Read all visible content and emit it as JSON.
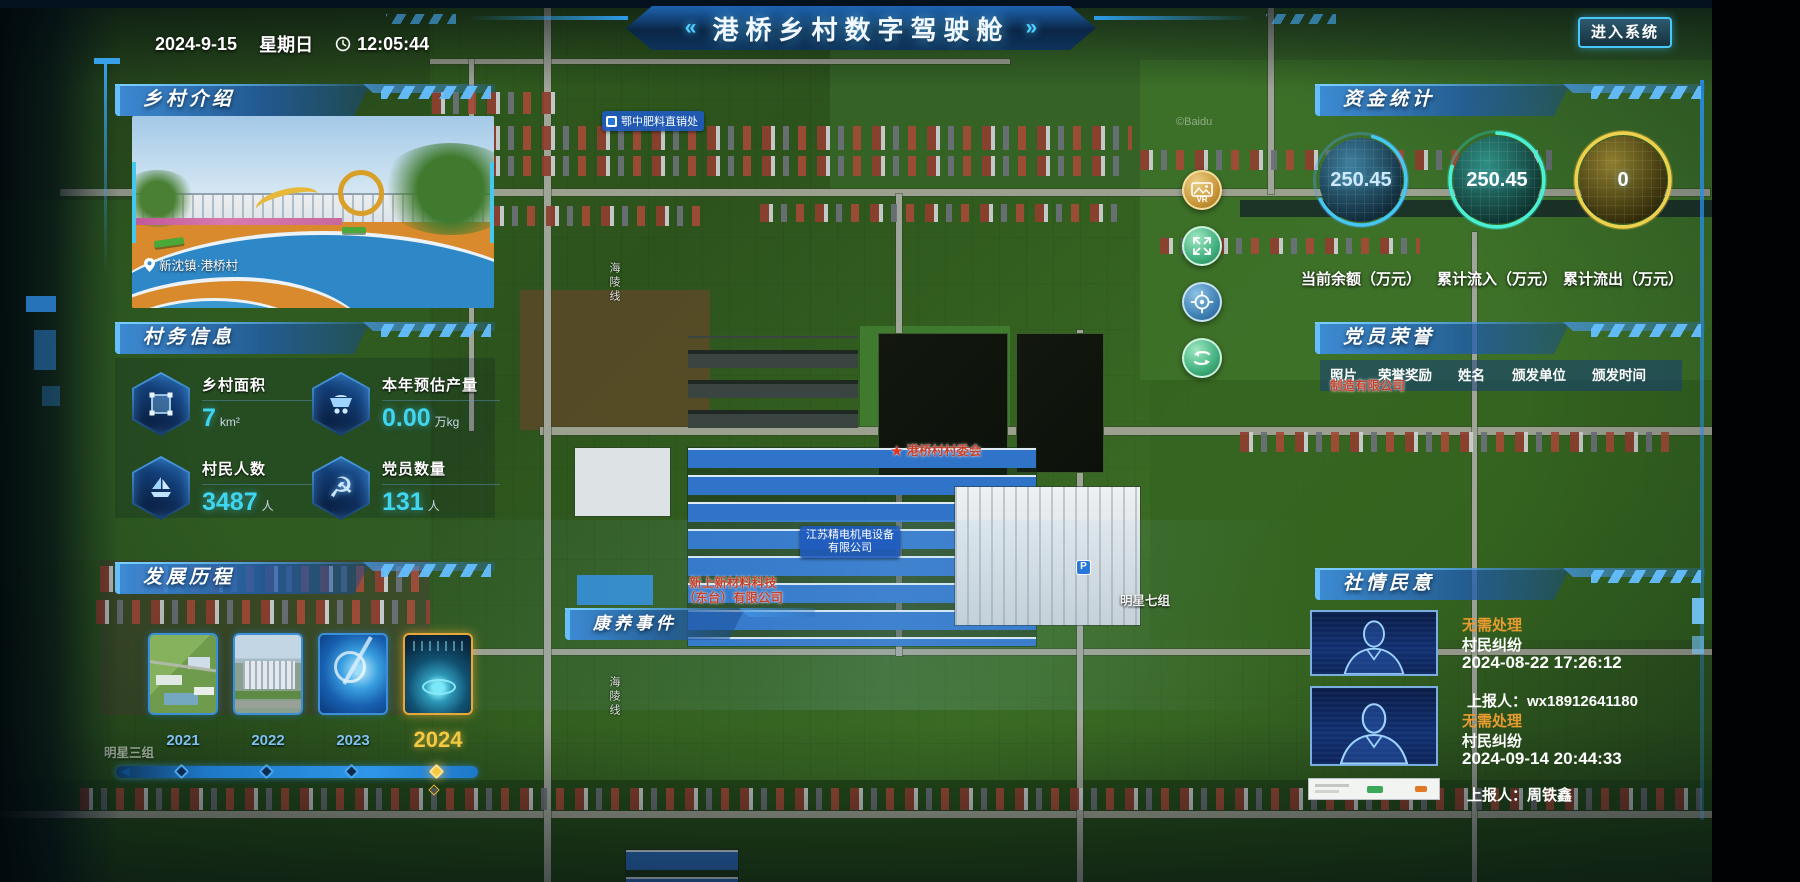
{
  "header": {
    "date": "2024-9-15",
    "weekday": "星期日",
    "time": "12:05:44",
    "deco_left": "«",
    "title": "港桥乡村数字驾驶舱",
    "deco_right": "»",
    "enter_button": "进入系统"
  },
  "left": {
    "intro": {
      "title": "乡村介绍",
      "photo_caption": "新沈镇·港桥村"
    },
    "info": {
      "title": "村务信息",
      "stats": [
        {
          "label": "乡村面积",
          "value": "7",
          "unit": "km²"
        },
        {
          "label": "本年预估产量",
          "value": "0.00",
          "unit": "万kg"
        },
        {
          "label": "村民人数",
          "value": "3487",
          "unit": "人"
        },
        {
          "label": "党员数量",
          "value": "131",
          "unit": "人"
        }
      ]
    },
    "development": {
      "title": "发展历程",
      "years": [
        "2021",
        "2022",
        "2023",
        "2024"
      ],
      "active_year": "2024"
    }
  },
  "right": {
    "funds": {
      "title": "资金统计",
      "gauges": [
        {
          "value": "250.45",
          "label": "当前余额（万元）"
        },
        {
          "value": "250.45",
          "label": "累计流入（万元）"
        },
        {
          "value": "0",
          "label": "累计流出（万元）"
        }
      ]
    },
    "party": {
      "title": "党员荣誉",
      "columns": [
        "照片",
        "荣誉奖励",
        "姓名",
        "颁发单位",
        "颁发时间"
      ]
    },
    "sentiment": {
      "title": "社情民意",
      "items": [
        {
          "status": "无需处理",
          "category": "村民纠纷",
          "datetime": "2024-08-22 17:26:12",
          "reporter": "上报人：wx18912641180"
        },
        {
          "status": "无需处理",
          "category": "村民纠纷",
          "datetime": "2024-09-14 20:44:33",
          "reporter": "上报人：周铁鑫"
        }
      ]
    }
  },
  "center": {
    "health_panel_title": "康养事件"
  },
  "map_labels": {
    "fertilizer_poi": "鄂中肥料直销处",
    "village_committee": "港桥村村委会",
    "company_blue_1": "江苏精电机电设备",
    "company_blue_2": "有限公司",
    "company_red_1": "新上新材料科技",
    "company_red_2": "（东台）有限公司",
    "company_red_fragment": "制造有限公司",
    "group7": "明星七组",
    "group3": "明星三组",
    "road": "海陵线",
    "parking": "P",
    "watermark": "©Baidu",
    "vr_badge": "VR"
  },
  "colors": {
    "accent": "#35c8ff",
    "gold": "#f5c842",
    "status_orange": "#e89b2e",
    "value_cyan": "#3fd6f2"
  }
}
